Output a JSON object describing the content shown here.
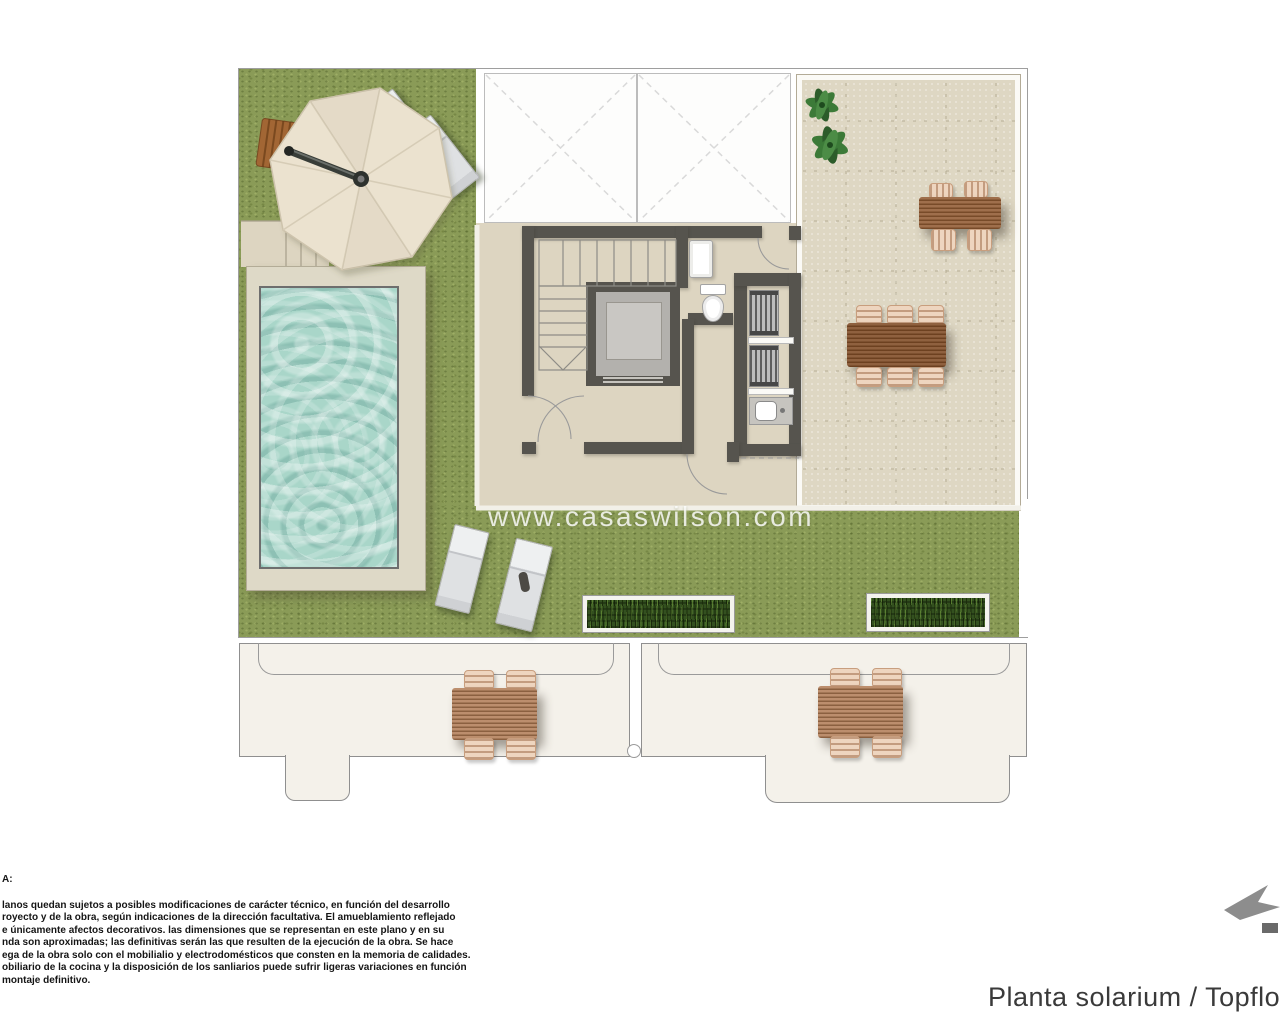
{
  "title": {
    "text": "Planta solarium / Topfloor"
  },
  "watermark": {
    "text": "www.casaswilson.com"
  },
  "note": {
    "heading": "A:",
    "lines": [
      "lanos quedan sujetos a posibles modificaciones de carácter técnico, en función del desarrollo",
      "royecto y de la obra, según indicaciones de la dirección facultativa. El amueblamiento reflejado",
      "e únicamente afectos decorativos. las dimensiones que se representan en este plano y en su",
      "nda son aproximadas; las definitivas serán las que resulten de la ejecución de la obra. Se hace",
      "ega de la obra solo con el mobilialio y electrodomésticos que consten en la memoria de calidades.",
      "obiliario de la cocina y la disposición de los sanliarios puede sufrir ligeras variaciones en función",
      "montaje definitivo."
    ]
  },
  "plan": {
    "label": "solarium floor plan",
    "features": [
      "swimming-pool",
      "parasol",
      "sun-loungers",
      "staircase",
      "elevator",
      "toilet",
      "cistern",
      "sink",
      "louvre-units",
      "dining-table-six-seats",
      "dining-table-four-seats",
      "hedge-planters",
      "potted-plant",
      "skylights",
      "lower-terraces-with-tables"
    ],
    "colors": {
      "grass": "#8a9b57",
      "terrace": "#ded7c3",
      "wall": "#56544e",
      "pool_water": "#a9d6c9",
      "pool_deck": "#ded9c7",
      "wood": "#96613a",
      "chair": "#eed5bf",
      "hedge": "#33501f",
      "lower_room": "#f4f1ea",
      "logo": "#8d8d8d"
    }
  }
}
